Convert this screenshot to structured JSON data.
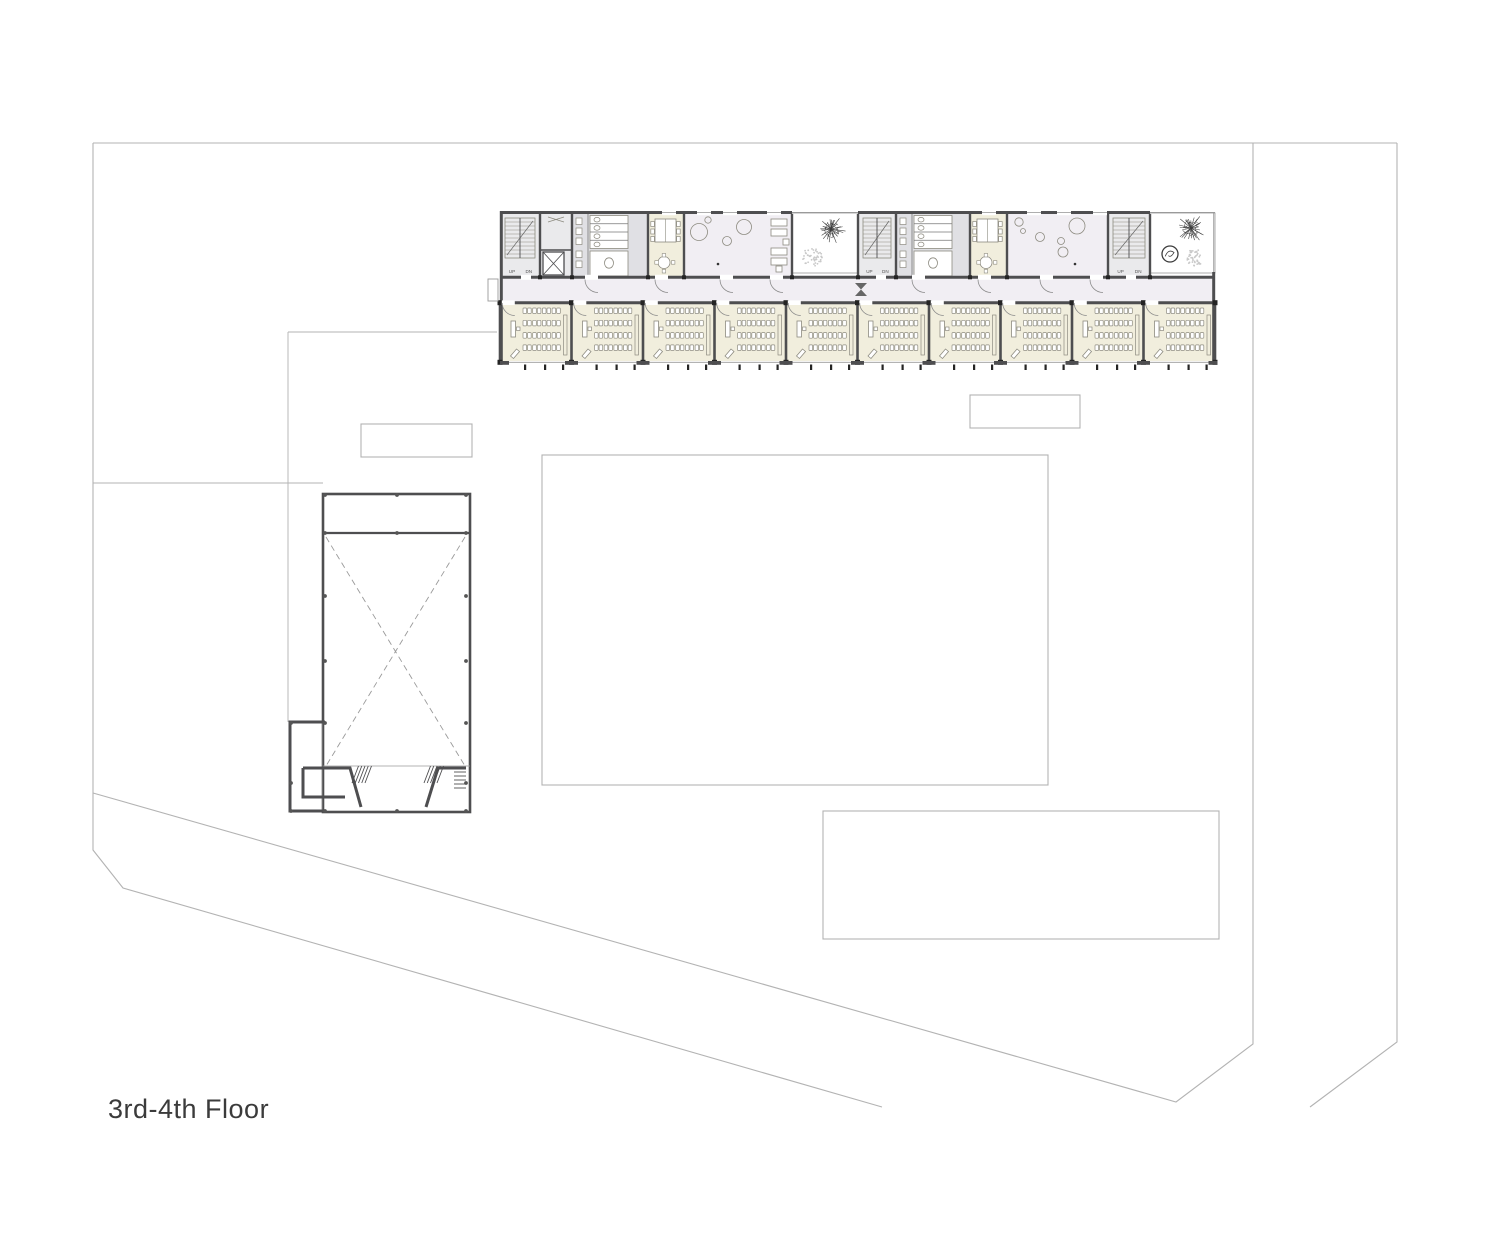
{
  "meta": {
    "floor_label": "3rd-4th Floor"
  },
  "canvas": {
    "w": 1500,
    "h": 1250
  },
  "colors": {
    "site_line": "#b3b3b3",
    "wall": "#4e4e50",
    "cap": "#242424",
    "thin": "#9a9a9a",
    "cream": "#f1eedd",
    "gray": "#e0e0e4",
    "stair_gray": "#eaeaec",
    "lavender": "#f1eef3",
    "furn": "#8d8b80",
    "tree_dark": "#3c3c3c",
    "tree_light": "#c9c9c9",
    "text": "#3b3b3b",
    "white": "#ffffff",
    "door": "#8a8a8a"
  },
  "site": {
    "boundary": [
      [
        [
          93,
          143
        ],
        [
          1397,
          143
        ]
      ],
      [
        [
          93,
          143
        ],
        [
          93,
          850
        ],
        [
          123,
          888
        ],
        [
          882,
          1107
        ]
      ],
      [
        [
          1253,
          143
        ],
        [
          1253,
          1044
        ],
        [
          1176,
          1102
        ],
        [
          93,
          793
        ]
      ],
      [
        [
          1397,
          143
        ],
        [
          1397,
          1042
        ],
        [
          1310,
          1107
        ]
      ]
    ],
    "paths": [
      [
        [
          288,
          332
        ],
        [
          497,
          332
        ]
      ],
      [
        [
          288,
          332
        ],
        [
          288,
          722
        ]
      ],
      [
        [
          93,
          483
        ],
        [
          323,
          483
        ]
      ]
    ],
    "rects": [
      {
        "name": "site-rect-west",
        "x": 361,
        "y": 424,
        "w": 111,
        "h": 33
      },
      {
        "name": "site-rect-east",
        "x": 970,
        "y": 395,
        "w": 110,
        "h": 33
      },
      {
        "name": "courtyard-rect",
        "x": 542,
        "y": 455,
        "w": 506,
        "h": 330
      },
      {
        "name": "site-rect-south",
        "x": 823,
        "y": 811,
        "w": 396,
        "h": 128
      }
    ]
  },
  "building": {
    "x0": 500,
    "x1": 1215,
    "top": 211,
    "room_top": 214,
    "room_bottom": 276,
    "corridor_top": 279,
    "corridor_bottom": 301,
    "class_top": 304,
    "class_bottom": 361,
    "balcony": {
      "x": 488,
      "y": 279,
      "w": 10,
      "h": 22
    },
    "bowtie": {
      "x": 855,
      "y": 283,
      "w": 12,
      "h": 13
    },
    "windows_top": [
      662,
      697,
      723,
      767,
      982,
      1027,
      1057,
      1093
    ],
    "door_gaps_corridor": [
      585,
      655,
      720,
      770,
      912,
      978,
      1040,
      1090
    ],
    "stair_door_gaps": [
      521,
      876,
      1126
    ],
    "upper_dividers": [
      540,
      572,
      648,
      684,
      792,
      858,
      896,
      970,
      1007,
      1108,
      1150
    ],
    "upper_rooms": [
      {
        "type": "stair",
        "x": 500,
        "w": 40
      },
      {
        "type": "elevator",
        "x": 540,
        "w": 32
      },
      {
        "type": "wc",
        "x": 572,
        "w": 76
      },
      {
        "type": "seminar",
        "x": 648,
        "w": 36
      },
      {
        "type": "hall",
        "x": 684,
        "w": 108,
        "circles": [
          [
            699,
            232,
            8.5
          ],
          [
            708,
            220,
            3.2
          ],
          [
            744,
            227,
            7.5
          ],
          [
            727,
            241,
            4.5
          ]
        ],
        "dot": [
          718,
          264
        ],
        "sofas": [
          [
            771,
            219,
            16,
            7
          ],
          [
            771,
            229,
            16,
            7
          ],
          [
            771,
            248,
            16,
            7
          ],
          [
            771,
            258,
            16,
            7
          ],
          [
            783,
            239,
            6,
            6
          ],
          [
            776,
            266,
            6,
            6
          ]
        ]
      },
      {
        "type": "terrace",
        "x": 792,
        "w": 66,
        "trees": [
          {
            "k": "branch",
            "c": [
              831,
              229
            ],
            "r": 15
          },
          {
            "k": "stipple",
            "c": [
              812,
              257
            ],
            "r": 10
          }
        ]
      },
      {
        "type": "stair",
        "x": 858,
        "w": 38
      },
      {
        "type": "wc",
        "x": 896,
        "w": 74
      },
      {
        "type": "seminar",
        "x": 970,
        "w": 37
      },
      {
        "type": "hall",
        "x": 1007,
        "w": 101,
        "circles": [
          [
            1019,
            222,
            4.2
          ],
          [
            1023,
            231,
            2.5
          ],
          [
            1040,
            237,
            4.5
          ],
          [
            1077,
            226,
            8
          ],
          [
            1061,
            241,
            3.5
          ],
          [
            1063,
            252,
            5
          ]
        ],
        "dot": [
          1075,
          264
        ]
      },
      {
        "type": "stair",
        "x": 1108,
        "w": 42
      },
      {
        "type": "terrace",
        "x": 1150,
        "w": 65,
        "trees": [
          {
            "k": "branch",
            "c": [
              1191,
              228
            ],
            "r": 15
          },
          {
            "k": "bush",
            "c": [
              1170,
              254
            ],
            "r": 8
          },
          {
            "k": "stipple",
            "c": [
              1195,
              257
            ],
            "r": 9
          }
        ]
      }
    ],
    "classrooms": {
      "count": 10,
      "x0": 500,
      "pitch": 71.5
    },
    "stair_labels": {
      "up": "UP",
      "dn": "DN"
    }
  },
  "gym": {
    "x": 323,
    "y": 494,
    "w": 147,
    "h": 318,
    "strip_y": 533,
    "hall_bottom": 766,
    "dash_x": [
      [
        [
          326,
          537
        ],
        [
          465,
          766
        ]
      ],
      [
        [
          465,
          537
        ],
        [
          326,
          766
        ]
      ]
    ],
    "dots": [
      [
        325,
        495
      ],
      [
        397,
        495
      ],
      [
        466,
        495
      ],
      [
        325,
        533
      ],
      [
        397,
        533
      ],
      [
        466,
        533
      ],
      [
        325,
        596
      ],
      [
        325,
        661
      ],
      [
        466,
        596
      ],
      [
        466,
        661
      ],
      [
        291,
        723
      ],
      [
        325,
        723
      ],
      [
        466,
        723
      ],
      [
        291,
        783
      ],
      [
        466,
        783
      ],
      [
        291,
        811
      ],
      [
        325,
        811
      ],
      [
        397,
        811
      ],
      [
        466,
        811
      ]
    ],
    "entry_walls": [
      [
        [
          303,
          768
        ],
        [
          350,
          768
        ],
        [
          361,
          807
        ]
      ],
      [
        [
          303,
          768
        ],
        [
          303,
          797
        ],
        [
          345,
          797
        ]
      ],
      [
        [
          426,
          807
        ],
        [
          438,
          768
        ],
        [
          466,
          768
        ]
      ],
      [
        [
          325,
          722
        ],
        [
          290,
          722
        ],
        [
          290,
          811
        ],
        [
          323,
          811
        ]
      ]
    ],
    "thin_lines": [
      [
        [
          322,
          722
        ],
        [
          322,
          810
        ]
      ],
      [
        [
          323,
          766
        ],
        [
          470,
          766
        ]
      ]
    ],
    "stairs": [
      {
        "x": 352,
        "y": 766,
        "w": 13,
        "h": 17,
        "dir": "diag"
      },
      {
        "x": 424,
        "y": 766,
        "w": 13,
        "h": 17,
        "dir": "diag"
      },
      {
        "x": 454,
        "y": 772,
        "w": 12,
        "h": 16,
        "dir": "horiz"
      }
    ]
  }
}
